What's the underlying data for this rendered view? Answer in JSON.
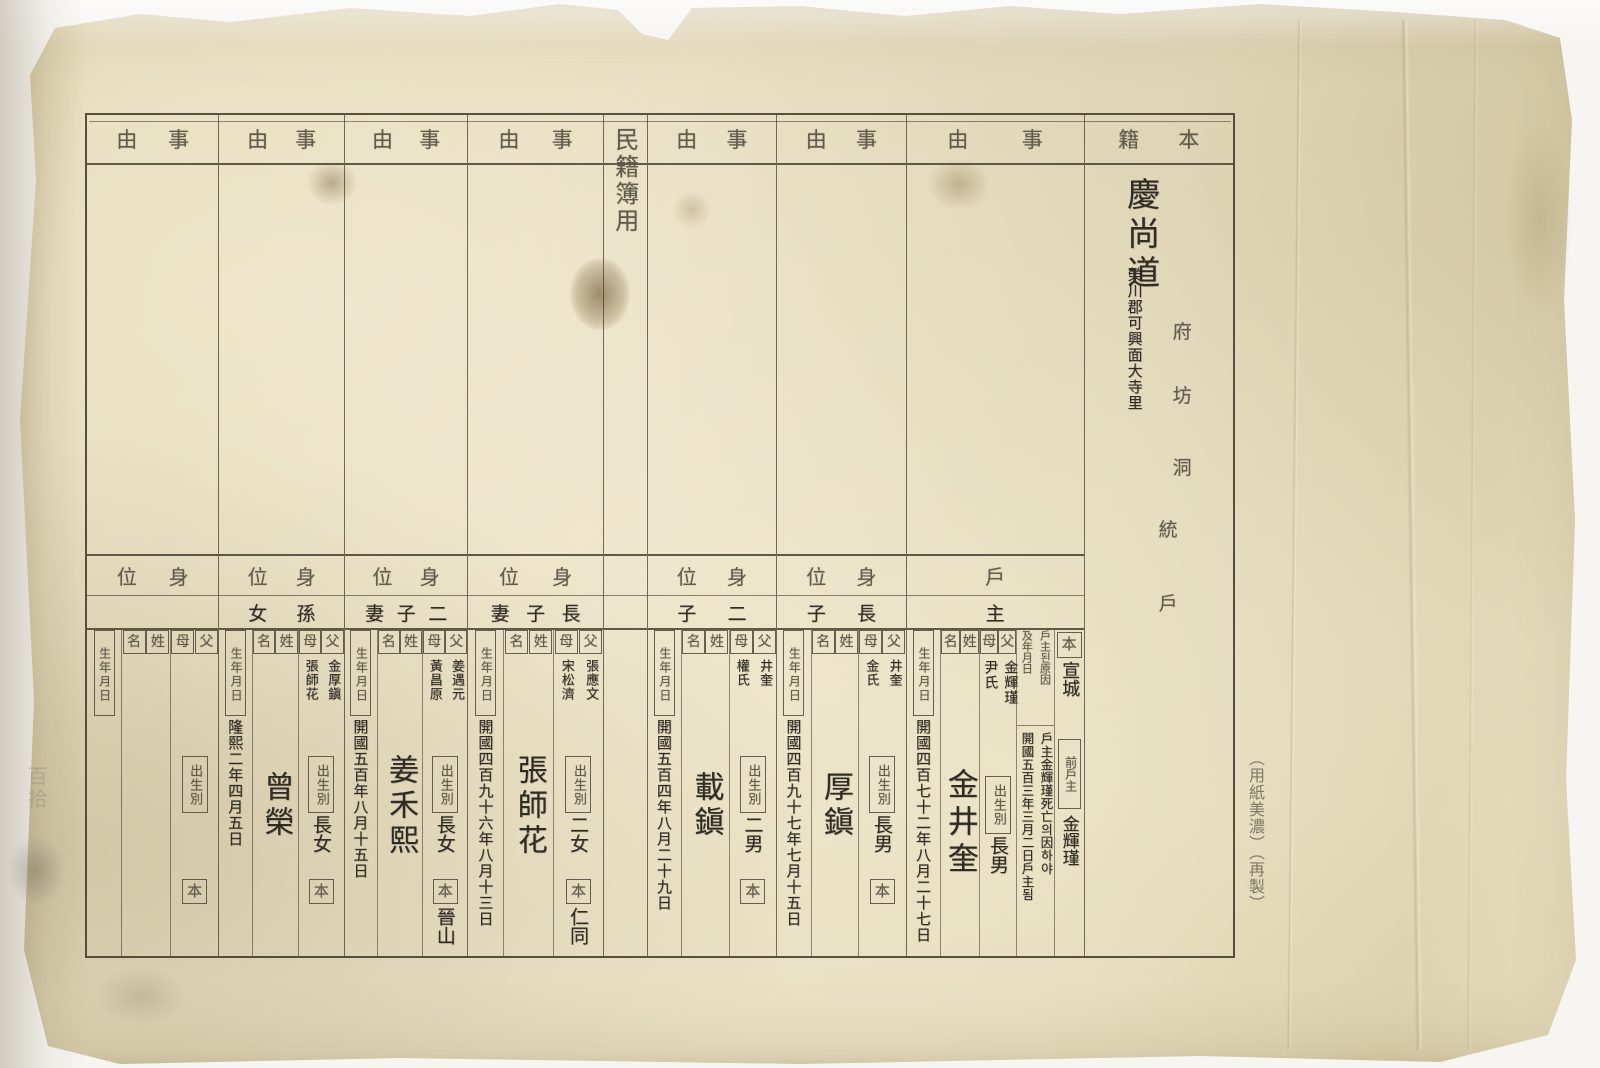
{
  "meta": {
    "document_type": "scanned historical Korean household register form (Minjeokbu)",
    "ink_color": "#2e2c25",
    "printed_template_color": "#615c4c",
    "paper_color": "#ebe2c6"
  },
  "labels": {
    "honseki": "本籍",
    "jiyu": "事由",
    "minjeokbu": "民籍簿用",
    "sini": "身位",
    "father": "父",
    "mother": "母",
    "seong": "姓",
    "myeong": "名",
    "birth": "生年月日",
    "birth_order": "出生別",
    "bon": "本",
    "prev_householder": "前戶主",
    "reason_line1": "戶主된原因",
    "reason_line2": "及年月日",
    "ho": "戶",
    "ju": "主",
    "tong": "統",
    "fu": "府",
    "bang": "坊",
    "dong": "洞"
  },
  "address": {
    "province": "慶尚道",
    "detail": "榮川郡可興面大寺里"
  },
  "persons": [
    {
      "relation": "戶主",
      "bon_origin": "宣城",
      "prev_householder": "金輝瑾",
      "reason_text_1": "戶主金輝瑾死亡의因하야",
      "reason_text_2": "開國五百三年三月二日戶主됨",
      "father": "金輝瑾",
      "mother": "尹氏",
      "birth_order": "長男",
      "name": "金井奎",
      "birth_date": "開國四百七十二年八月二十七日"
    },
    {
      "relation": "長子",
      "father": "井奎",
      "mother": "金氏",
      "birth_order": "長男",
      "clan": "",
      "name": "厚鎭",
      "birth_date": "開國四百九十七年七月十五日"
    },
    {
      "relation": "二子",
      "father": "井奎",
      "mother": "權氏",
      "birth_order": "二男",
      "clan": "",
      "name": "載鎭",
      "birth_date": "開國五百四年八月二十九日"
    },
    {
      "relation": "長子妻",
      "father": "張應文",
      "mother": "宋松濟",
      "birth_order": "二女",
      "clan": "仁同",
      "name": "張師花",
      "birth_date": "開國四百九十六年八月十三日"
    },
    {
      "relation": "二子妻",
      "father": "姜遇元",
      "mother": "黃昌原",
      "birth_order": "長女",
      "clan": "晉山",
      "name": "姜禾熙",
      "birth_date": "開國五百年八月十五日"
    },
    {
      "relation": "孫女",
      "father": "金厚鎭",
      "mother": "張師花",
      "birth_order": "長女",
      "clan": "",
      "name": "曾榮",
      "birth_date": "隆熙二年四月五日"
    },
    {
      "relation": "",
      "father": "",
      "mother": "",
      "birth_order": "",
      "clan": "",
      "name": "",
      "birth_date": ""
    }
  ],
  "margins": {
    "right_stamp": "（用紙美濃）（再製）",
    "left_faint_text": "百拾"
  }
}
